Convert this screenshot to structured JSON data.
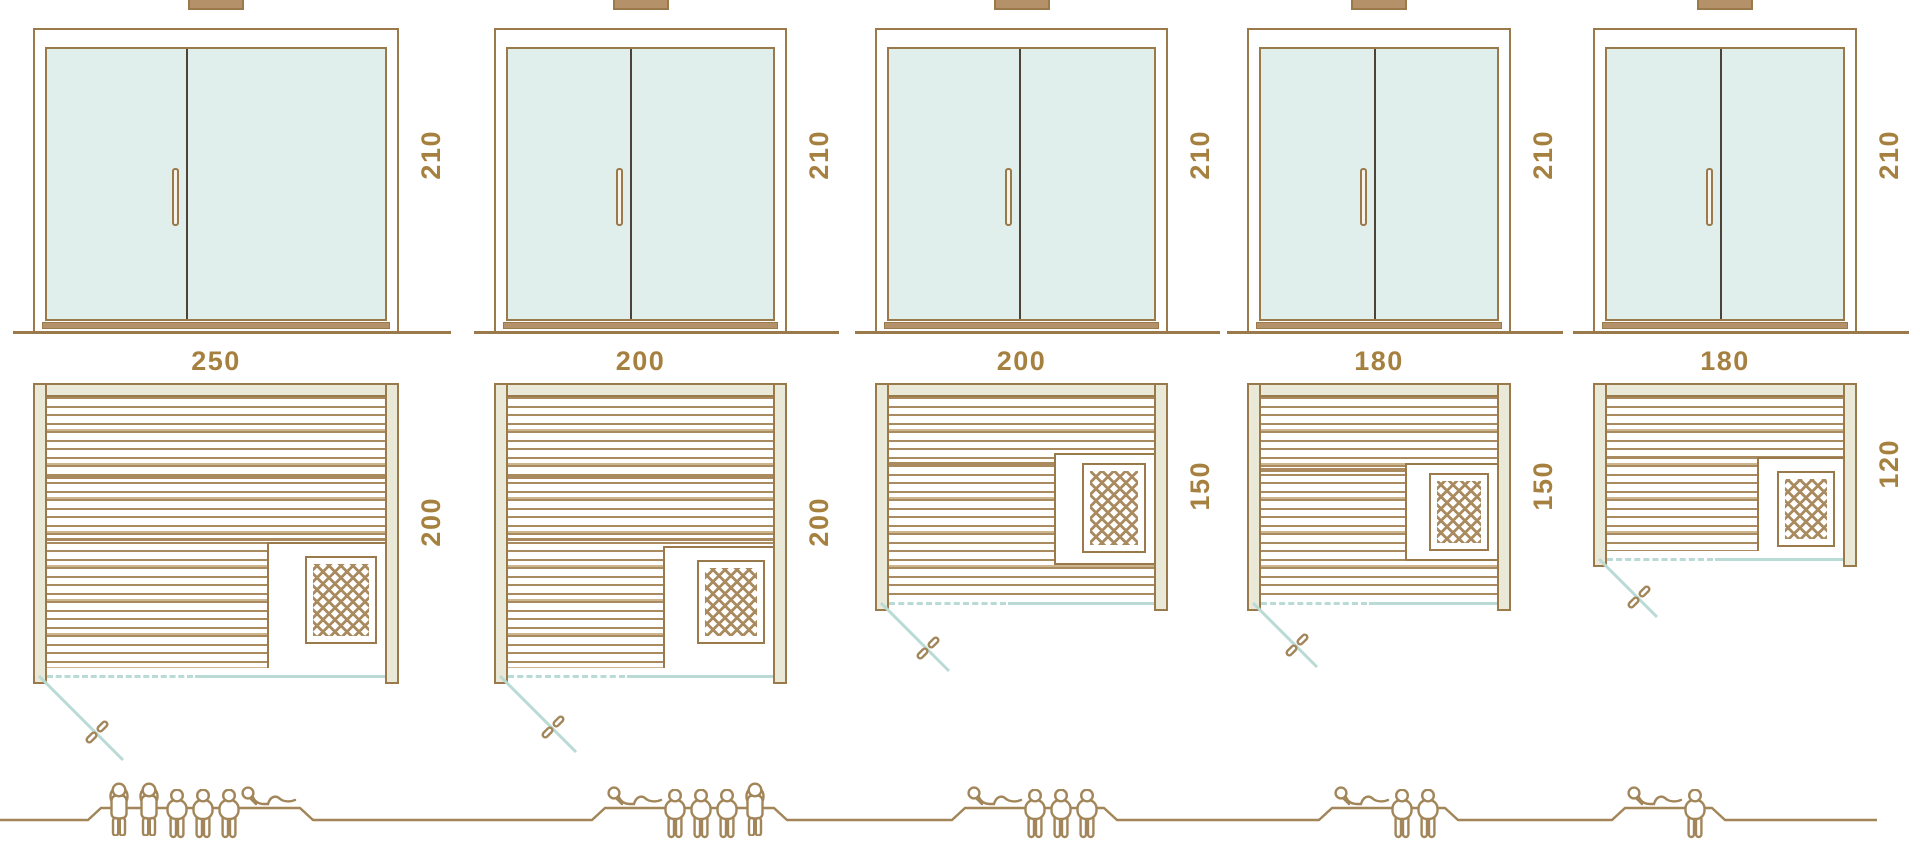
{
  "palette": {
    "line-brown": "#9a7a4a",
    "slat-brown": "#a98b5f",
    "slat-light": "#cdb68f",
    "text-brown": "#a6803f",
    "wall-fill": "#eae8d6",
    "glass-fill": "#e0efeb",
    "divider-dark": "#4e4337",
    "sill-brown": "#b5916a",
    "teal-line": "#b9dad5",
    "people-brown": "#a28659"
  },
  "units": [
    {
      "id": "sauna-250x200",
      "door_height_label": "210",
      "width_label": "250",
      "depth_label": "200",
      "people": [
        "standing",
        "standing",
        "sitting",
        "sitting",
        "sitting",
        "lying"
      ]
    },
    {
      "id": "sauna-200x200",
      "door_height_label": "210",
      "width_label": "200",
      "depth_label": "200",
      "people": [
        "lying",
        "sitting",
        "sitting",
        "sitting",
        "standing"
      ]
    },
    {
      "id": "sauna-200x150",
      "door_height_label": "210",
      "width_label": "200",
      "depth_label": "150",
      "people": [
        "lying",
        "sitting",
        "sitting",
        "sitting"
      ]
    },
    {
      "id": "sauna-180x150",
      "door_height_label": "210",
      "width_label": "180",
      "depth_label": "150",
      "people": [
        "lying",
        "sitting",
        "sitting"
      ]
    },
    {
      "id": "sauna-180x120",
      "door_height_label": "210",
      "width_label": "180",
      "depth_label": "120",
      "people": [
        "lying",
        "sitting"
      ]
    }
  ]
}
